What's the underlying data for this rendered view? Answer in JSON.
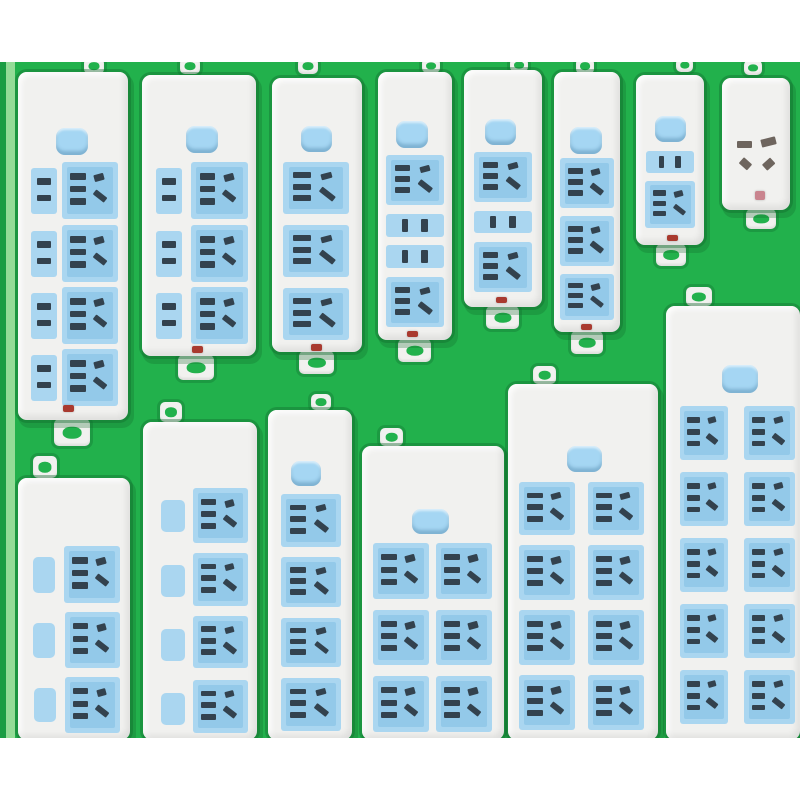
{
  "scene": {
    "background_color": "#22b14c",
    "shadow_color": "rgba(17,104,44,0.4)",
    "top_band": {
      "y": 0,
      "h": 62,
      "color": "#ffffff"
    },
    "bottom_band": {
      "y": 738,
      "h": 62,
      "color": "#ffffff"
    },
    "left_edge_stripe_dark": {
      "x": 0,
      "w": 6,
      "color": "#1a9d43"
    },
    "left_edge_stripe_light": {
      "x": 6,
      "w": 9,
      "color": "#94dc97"
    },
    "strip_body_color": "#f1f1ef",
    "socket_pad_color": "#aad6f0",
    "socket_pad_inner_color": "#93c9e9",
    "hole_color": "#33424e",
    "face_hole_color": "#6e655e",
    "button_color": "#a5d6f3",
    "tab_hole_color": "#22b14c",
    "indicator_colors": {
      "red": "#a93a2f",
      "pink": "#c9848e"
    }
  },
  "strips": [
    {
      "id": "top-1",
      "x": 18,
      "y": 72,
      "w": 110,
      "h": 348,
      "tab": {
        "x": 84,
        "y": 58,
        "w": 20,
        "h": 16
      },
      "button": {
        "x": 56,
        "y": 128,
        "w": 32,
        "h": 27
      },
      "modules": [
        {
          "t": "mini",
          "x": 31,
          "y": 168,
          "w": 26,
          "h": 46
        },
        {
          "t": "socket",
          "x": 62,
          "y": 162,
          "w": 56,
          "h": 57
        },
        {
          "t": "mini",
          "x": 31,
          "y": 231,
          "w": 26,
          "h": 46
        },
        {
          "t": "socket",
          "x": 62,
          "y": 225,
          "w": 56,
          "h": 57
        },
        {
          "t": "mini",
          "x": 31,
          "y": 293,
          "w": 26,
          "h": 46
        },
        {
          "t": "socket",
          "x": 62,
          "y": 287,
          "w": 56,
          "h": 57
        },
        {
          "t": "mini",
          "x": 31,
          "y": 355,
          "w": 26,
          "h": 46
        },
        {
          "t": "socket",
          "x": 62,
          "y": 349,
          "w": 56,
          "h": 57
        }
      ],
      "indicator": {
        "x": 63,
        "y": 405,
        "w": 11,
        "h": 7,
        "c": "red"
      },
      "handle": {
        "x": 54,
        "y": 419,
        "w": 36,
        "h": 27
      }
    },
    {
      "id": "top-2",
      "x": 142,
      "y": 75,
      "w": 114,
      "h": 281,
      "tab": {
        "x": 180,
        "y": 58,
        "w": 20,
        "h": 16
      },
      "button": {
        "x": 186,
        "y": 126,
        "w": 32,
        "h": 27
      },
      "modules": [
        {
          "t": "mini",
          "x": 156,
          "y": 168,
          "w": 26,
          "h": 46
        },
        {
          "t": "socket",
          "x": 191,
          "y": 162,
          "w": 57,
          "h": 57
        },
        {
          "t": "mini",
          "x": 156,
          "y": 231,
          "w": 26,
          "h": 46
        },
        {
          "t": "socket",
          "x": 191,
          "y": 225,
          "w": 57,
          "h": 57
        },
        {
          "t": "mini",
          "x": 156,
          "y": 293,
          "w": 26,
          "h": 46
        },
        {
          "t": "socket",
          "x": 191,
          "y": 287,
          "w": 57,
          "h": 57
        }
      ],
      "indicator": {
        "x": 192,
        "y": 346,
        "w": 11,
        "h": 7,
        "c": "red"
      },
      "handle": {
        "x": 178,
        "y": 355,
        "w": 36,
        "h": 25
      }
    },
    {
      "id": "top-3",
      "x": 272,
      "y": 78,
      "w": 90,
      "h": 274,
      "tab": {
        "x": 298,
        "y": 58,
        "w": 20,
        "h": 16
      },
      "button": {
        "x": 301,
        "y": 126,
        "w": 31,
        "h": 26
      },
      "modules": [
        {
          "t": "socket",
          "x": 283,
          "y": 162,
          "w": 66,
          "h": 52
        },
        {
          "t": "socket",
          "x": 283,
          "y": 225,
          "w": 66,
          "h": 52
        },
        {
          "t": "socket",
          "x": 283,
          "y": 288,
          "w": 66,
          "h": 52
        }
      ],
      "indicator": {
        "x": 311,
        "y": 344,
        "w": 11,
        "h": 7,
        "c": "red"
      },
      "handle": {
        "x": 299,
        "y": 351,
        "w": 35,
        "h": 23
      }
    },
    {
      "id": "top-4",
      "x": 378,
      "y": 72,
      "w": 74,
      "h": 268,
      "tab": {
        "x": 422,
        "y": 58,
        "w": 18,
        "h": 15
      },
      "button": {
        "x": 396,
        "y": 121,
        "w": 32,
        "h": 27
      },
      "modules": [
        {
          "t": "socket",
          "x": 386,
          "y": 155,
          "w": 58,
          "h": 50
        },
        {
          "t": "bar2",
          "x": 386,
          "y": 214,
          "w": 58,
          "h": 23
        },
        {
          "t": "bar2",
          "x": 386,
          "y": 245,
          "w": 58,
          "h": 23
        },
        {
          "t": "socket",
          "x": 386,
          "y": 277,
          "w": 58,
          "h": 50
        }
      ],
      "indicator": {
        "x": 407,
        "y": 331,
        "w": 11,
        "h": 6,
        "c": "red"
      },
      "handle": {
        "x": 398,
        "y": 339,
        "w": 33,
        "h": 23
      }
    },
    {
      "id": "top-5",
      "x": 464,
      "y": 70,
      "w": 78,
      "h": 237,
      "tab": {
        "x": 510,
        "y": 58,
        "w": 18,
        "h": 14
      },
      "button": {
        "x": 485,
        "y": 119,
        "w": 31,
        "h": 26
      },
      "modules": [
        {
          "t": "socket",
          "x": 474,
          "y": 152,
          "w": 58,
          "h": 50
        },
        {
          "t": "bar2",
          "x": 474,
          "y": 211,
          "w": 58,
          "h": 22
        },
        {
          "t": "socket",
          "x": 474,
          "y": 242,
          "w": 58,
          "h": 50
        }
      ],
      "indicator": {
        "x": 496,
        "y": 297,
        "w": 11,
        "h": 6,
        "c": "red"
      },
      "handle": {
        "x": 486,
        "y": 306,
        "w": 33,
        "h": 23
      }
    },
    {
      "id": "top-6",
      "x": 554,
      "y": 72,
      "w": 66,
      "h": 260,
      "tab": {
        "x": 576,
        "y": 58,
        "w": 18,
        "h": 16
      },
      "button": {
        "x": 570,
        "y": 127,
        "w": 32,
        "h": 27
      },
      "modules": [
        {
          "t": "socket",
          "x": 560,
          "y": 158,
          "w": 54,
          "h": 50
        },
        {
          "t": "socket",
          "x": 560,
          "y": 216,
          "w": 54,
          "h": 50
        },
        {
          "t": "socket",
          "x": 560,
          "y": 274,
          "w": 54,
          "h": 46
        }
      ],
      "indicator": {
        "x": 581,
        "y": 324,
        "w": 11,
        "h": 6,
        "c": "red"
      },
      "handle": {
        "x": 571,
        "y": 331,
        "w": 32,
        "h": 23
      }
    },
    {
      "id": "top-7",
      "x": 636,
      "y": 75,
      "w": 68,
      "h": 170,
      "tab": {
        "x": 676,
        "y": 58,
        "w": 17,
        "h": 14
      },
      "button": {
        "x": 655,
        "y": 116,
        "w": 31,
        "h": 26
      },
      "modules": [
        {
          "t": "bar2",
          "x": 646,
          "y": 151,
          "w": 48,
          "h": 22
        },
        {
          "t": "socket",
          "x": 645,
          "y": 181,
          "w": 50,
          "h": 47
        }
      ],
      "indicator": {
        "x": 667,
        "y": 235,
        "w": 11,
        "h": 6,
        "c": "red"
      },
      "handle": {
        "x": 656,
        "y": 244,
        "w": 30,
        "h": 22
      }
    },
    {
      "id": "top-8",
      "x": 722,
      "y": 78,
      "w": 68,
      "h": 132,
      "tab": {
        "x": 744,
        "y": 60,
        "w": 18,
        "h": 15
      },
      "modules": [
        {
          "t": "face",
          "x": 732,
          "y": 124,
          "w": 52,
          "h": 64
        }
      ],
      "indicator": {
        "x": 755,
        "y": 191,
        "w": 10,
        "h": 9,
        "c": "pink"
      },
      "handle": {
        "x": 746,
        "y": 209,
        "w": 30,
        "h": 20
      }
    },
    {
      "id": "bottom-1",
      "x": 18,
      "y": 478,
      "w": 112,
      "h": 262,
      "tab": {
        "x": 33,
        "y": 456,
        "w": 24,
        "h": 22
      },
      "modules": [
        {
          "t": "pill",
          "x": 33,
          "y": 557,
          "w": 22,
          "h": 36
        },
        {
          "t": "socket",
          "x": 64,
          "y": 546,
          "w": 56,
          "h": 57
        },
        {
          "t": "pill",
          "x": 33,
          "y": 623,
          "w": 22,
          "h": 35
        },
        {
          "t": "socket",
          "x": 65,
          "y": 612,
          "w": 55,
          "h": 56
        },
        {
          "t": "pill",
          "x": 34,
          "y": 688,
          "w": 22,
          "h": 34
        },
        {
          "t": "socket",
          "x": 65,
          "y": 677,
          "w": 55,
          "h": 56
        }
      ]
    },
    {
      "id": "bottom-2",
      "x": 143,
      "y": 422,
      "w": 114,
      "h": 318,
      "tab": {
        "x": 160,
        "y": 402,
        "w": 22,
        "h": 20
      },
      "modules": [
        {
          "t": "pill",
          "x": 161,
          "y": 500,
          "w": 24,
          "h": 32
        },
        {
          "t": "socket",
          "x": 193,
          "y": 488,
          "w": 55,
          "h": 55
        },
        {
          "t": "pill",
          "x": 161,
          "y": 565,
          "w": 24,
          "h": 32
        },
        {
          "t": "socket",
          "x": 193,
          "y": 553,
          "w": 55,
          "h": 53
        },
        {
          "t": "pill",
          "x": 161,
          "y": 629,
          "w": 24,
          "h": 32
        },
        {
          "t": "socket",
          "x": 193,
          "y": 616,
          "w": 55,
          "h": 52
        },
        {
          "t": "pill",
          "x": 161,
          "y": 693,
          "w": 24,
          "h": 32
        },
        {
          "t": "socket",
          "x": 193,
          "y": 680,
          "w": 55,
          "h": 53
        }
      ]
    },
    {
      "id": "bottom-3",
      "x": 268,
      "y": 410,
      "w": 84,
      "h": 330,
      "tab": {
        "x": 311,
        "y": 394,
        "w": 20,
        "h": 16
      },
      "button": {
        "x": 291,
        "y": 461,
        "w": 30,
        "h": 25
      },
      "modules": [
        {
          "t": "socket",
          "x": 281,
          "y": 494,
          "w": 60,
          "h": 53
        },
        {
          "t": "socket",
          "x": 281,
          "y": 557,
          "w": 60,
          "h": 50
        },
        {
          "t": "socket",
          "x": 281,
          "y": 618,
          "w": 60,
          "h": 49
        },
        {
          "t": "socket",
          "x": 281,
          "y": 678,
          "w": 60,
          "h": 53
        }
      ]
    },
    {
      "id": "bottom-4",
      "x": 362,
      "y": 446,
      "w": 142,
      "h": 294,
      "tab": {
        "x": 380,
        "y": 428,
        "w": 23,
        "h": 18
      },
      "button": {
        "x": 412,
        "y": 509,
        "w": 37,
        "h": 25
      },
      "modules": [
        {
          "t": "socket",
          "x": 373,
          "y": 543,
          "w": 56,
          "h": 56
        },
        {
          "t": "socket",
          "x": 436,
          "y": 543,
          "w": 56,
          "h": 56
        },
        {
          "t": "socket",
          "x": 373,
          "y": 610,
          "w": 56,
          "h": 55
        },
        {
          "t": "socket",
          "x": 436,
          "y": 610,
          "w": 56,
          "h": 55
        },
        {
          "t": "socket",
          "x": 373,
          "y": 676,
          "w": 56,
          "h": 56
        },
        {
          "t": "socket",
          "x": 436,
          "y": 676,
          "w": 56,
          "h": 56
        }
      ]
    },
    {
      "id": "bottom-5",
      "x": 508,
      "y": 384,
      "w": 150,
      "h": 356,
      "tab": {
        "x": 533,
        "y": 366,
        "w": 23,
        "h": 18
      },
      "button": {
        "x": 567,
        "y": 446,
        "w": 35,
        "h": 26
      },
      "modules": [
        {
          "t": "socket",
          "x": 519,
          "y": 482,
          "w": 56,
          "h": 53
        },
        {
          "t": "socket",
          "x": 588,
          "y": 482,
          "w": 56,
          "h": 53
        },
        {
          "t": "socket",
          "x": 519,
          "y": 545,
          "w": 56,
          "h": 55
        },
        {
          "t": "socket",
          "x": 588,
          "y": 545,
          "w": 56,
          "h": 55
        },
        {
          "t": "socket",
          "x": 519,
          "y": 610,
          "w": 56,
          "h": 55
        },
        {
          "t": "socket",
          "x": 588,
          "y": 610,
          "w": 56,
          "h": 55
        },
        {
          "t": "socket",
          "x": 519,
          "y": 675,
          "w": 56,
          "h": 55
        },
        {
          "t": "socket",
          "x": 588,
          "y": 675,
          "w": 56,
          "h": 55
        }
      ]
    },
    {
      "id": "bottom-6",
      "x": 666,
      "y": 306,
      "w": 134,
      "h": 434,
      "tab": {
        "x": 686,
        "y": 287,
        "w": 26,
        "h": 19
      },
      "button": {
        "x": 722,
        "y": 365,
        "w": 36,
        "h": 28
      },
      "modules": [
        {
          "t": "socket",
          "x": 680,
          "y": 406,
          "w": 48,
          "h": 54
        },
        {
          "t": "socket",
          "x": 744,
          "y": 406,
          "w": 51,
          "h": 54
        },
        {
          "t": "socket",
          "x": 680,
          "y": 472,
          "w": 48,
          "h": 54
        },
        {
          "t": "socket",
          "x": 744,
          "y": 472,
          "w": 51,
          "h": 54
        },
        {
          "t": "socket",
          "x": 680,
          "y": 538,
          "w": 48,
          "h": 54
        },
        {
          "t": "socket",
          "x": 744,
          "y": 538,
          "w": 51,
          "h": 54
        },
        {
          "t": "socket",
          "x": 680,
          "y": 604,
          "w": 48,
          "h": 54
        },
        {
          "t": "socket",
          "x": 744,
          "y": 604,
          "w": 51,
          "h": 54
        },
        {
          "t": "socket",
          "x": 680,
          "y": 670,
          "w": 48,
          "h": 54
        },
        {
          "t": "socket",
          "x": 744,
          "y": 670,
          "w": 51,
          "h": 54
        }
      ]
    }
  ]
}
